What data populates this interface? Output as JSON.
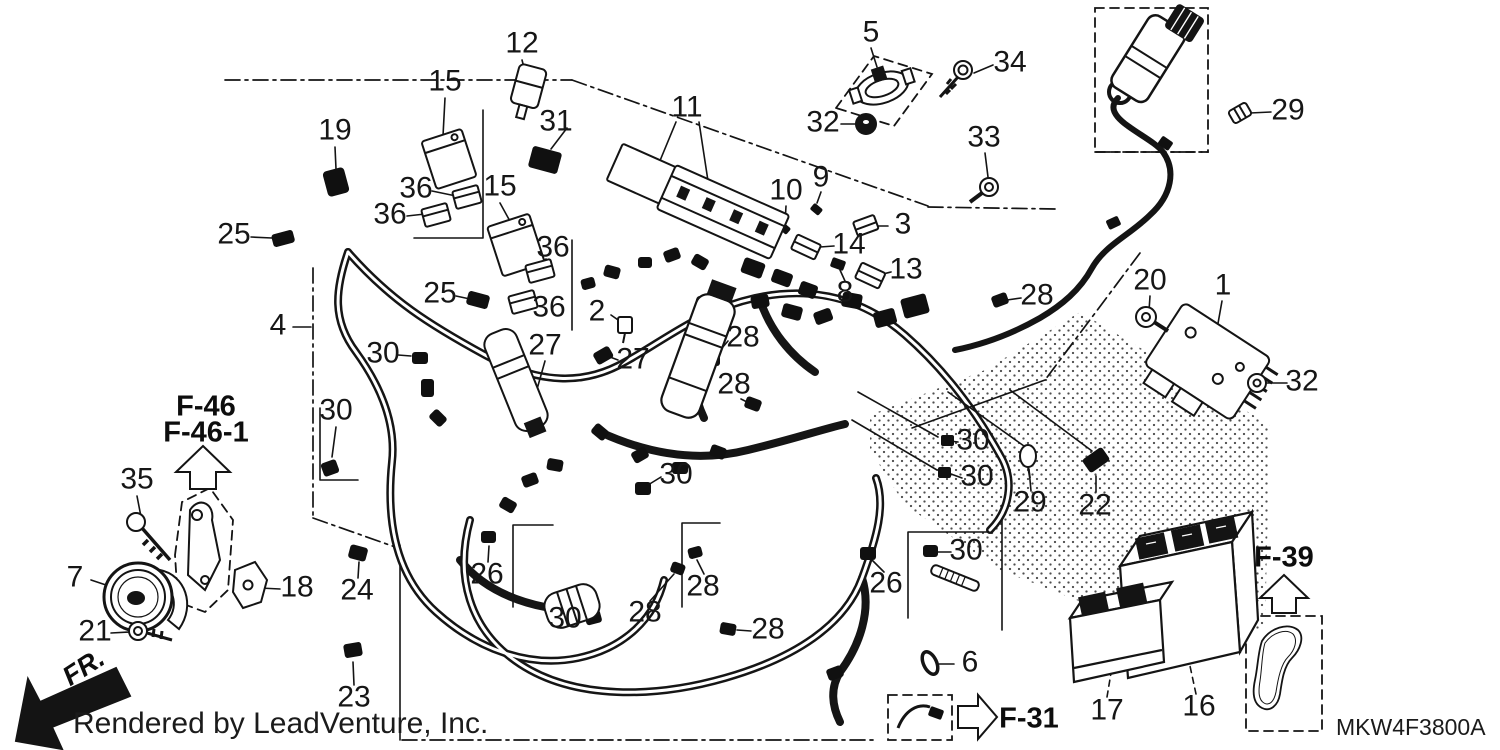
{
  "diagram": {
    "title": "wire harness parts diagram",
    "footer": "Rendered by LeadVenture, Inc.",
    "part_code": "MKW4F3800A",
    "fr_label": "FR.",
    "refs": {
      "f46": "F-46",
      "f46_1": "F-46-1",
      "f39": "F-39",
      "f31": "F-31"
    },
    "colors": {
      "line": "#141414",
      "background": "#ffffff"
    },
    "callouts": [
      {
        "text": "15",
        "x": 445,
        "y": 83
      },
      {
        "text": "12",
        "x": 522,
        "y": 45
      },
      {
        "text": "19",
        "x": 335,
        "y": 132
      },
      {
        "text": "31",
        "x": 556,
        "y": 123
      },
      {
        "text": "11",
        "x": 687,
        "y": 109
      },
      {
        "text": "5",
        "x": 871,
        "y": 34
      },
      {
        "text": "34",
        "x": 1010,
        "y": 64
      },
      {
        "text": "29",
        "x": 1288,
        "y": 112
      },
      {
        "text": "32",
        "x": 823,
        "y": 124
      },
      {
        "text": "33",
        "x": 984,
        "y": 139
      },
      {
        "text": "36",
        "x": 416,
        "y": 190
      },
      {
        "text": "15",
        "x": 500,
        "y": 188
      },
      {
        "text": "36",
        "x": 390,
        "y": 216
      },
      {
        "text": "9",
        "x": 821,
        "y": 179
      },
      {
        "text": "10",
        "x": 786,
        "y": 192
      },
      {
        "text": "25",
        "x": 234,
        "y": 236
      },
      {
        "text": "36",
        "x": 553,
        "y": 249
      },
      {
        "text": "3",
        "x": 903,
        "y": 226
      },
      {
        "text": "14",
        "x": 849,
        "y": 246
      },
      {
        "text": "13",
        "x": 906,
        "y": 271
      },
      {
        "text": "8",
        "x": 845,
        "y": 294
      },
      {
        "text": "36",
        "x": 549,
        "y": 309
      },
      {
        "text": "25",
        "x": 440,
        "y": 295
      },
      {
        "text": "2",
        "x": 597,
        "y": 313
      },
      {
        "text": "4",
        "x": 278,
        "y": 327
      },
      {
        "text": "28",
        "x": 1037,
        "y": 297
      },
      {
        "text": "20",
        "x": 1150,
        "y": 282
      },
      {
        "text": "1",
        "x": 1223,
        "y": 287
      },
      {
        "text": "30",
        "x": 383,
        "y": 355
      },
      {
        "text": "27",
        "x": 545,
        "y": 347
      },
      {
        "text": "27",
        "x": 633,
        "y": 361
      },
      {
        "text": "28",
        "x": 743,
        "y": 339
      },
      {
        "text": "28",
        "x": 734,
        "y": 386
      },
      {
        "text": "32",
        "x": 1302,
        "y": 383
      },
      {
        "text": "30",
        "x": 336,
        "y": 412
      },
      {
        "text": "30",
        "x": 676,
        "y": 476
      },
      {
        "text": "30",
        "x": 973,
        "y": 442
      },
      {
        "text": "30",
        "x": 977,
        "y": 478
      },
      {
        "text": "35",
        "x": 137,
        "y": 481
      },
      {
        "text": "29",
        "x": 1030,
        "y": 504
      },
      {
        "text": "22",
        "x": 1095,
        "y": 507
      },
      {
        "text": "30",
        "x": 966,
        "y": 552
      },
      {
        "text": "26",
        "x": 886,
        "y": 585
      },
      {
        "text": "26",
        "x": 487,
        "y": 576
      },
      {
        "text": "24",
        "x": 357,
        "y": 592
      },
      {
        "text": "7",
        "x": 75,
        "y": 579
      },
      {
        "text": "18",
        "x": 297,
        "y": 589
      },
      {
        "text": "21",
        "x": 95,
        "y": 633
      },
      {
        "text": "30",
        "x": 565,
        "y": 620
      },
      {
        "text": "28",
        "x": 645,
        "y": 614
      },
      {
        "text": "28",
        "x": 703,
        "y": 588
      },
      {
        "text": "28",
        "x": 768,
        "y": 631
      },
      {
        "text": "6",
        "x": 970,
        "y": 664
      },
      {
        "text": "23",
        "x": 354,
        "y": 699
      },
      {
        "text": "17",
        "x": 1107,
        "y": 712
      },
      {
        "text": "16",
        "x": 1199,
        "y": 708
      }
    ]
  }
}
